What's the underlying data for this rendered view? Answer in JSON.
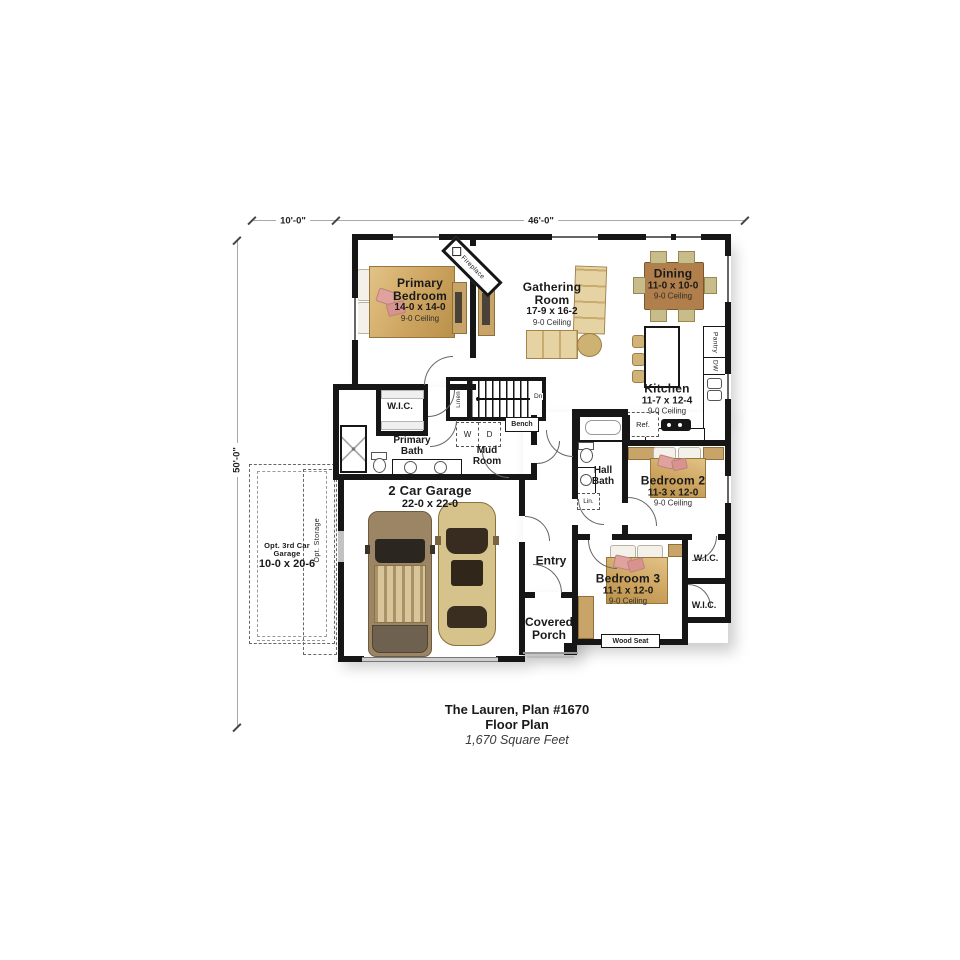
{
  "dims": {
    "top_left": "10'-0\"",
    "top_main": "46'-0\"",
    "left": "50'-0\""
  },
  "rooms": {
    "primary_bedroom": {
      "name": "Primary Bedroom",
      "size": "14-0 x 14-0",
      "ceiling": "9-0 Ceiling"
    },
    "gathering": {
      "name": "Gathering Room",
      "size": "17-9 x 16-2",
      "ceiling": "9-0 Ceiling"
    },
    "dining": {
      "name": "Dining",
      "size": "11-0 x 10-0",
      "ceiling": "9-0 Ceiling"
    },
    "kitchen": {
      "name": "Kitchen",
      "size": "11-7 x 12-4",
      "ceiling": "9-0 Ceiling"
    },
    "bedroom2": {
      "name": "Bedroom 2",
      "size": "11-3 x 12-0",
      "ceiling": "9-0 Ceiling"
    },
    "bedroom3": {
      "name": "Bedroom 3",
      "size": "11-1 x 12-0",
      "ceiling": "9-0 Ceiling"
    },
    "garage": {
      "name": "2 Car Garage",
      "size": "22-0 x 22-0"
    },
    "opt_garage": {
      "name": "Opt. 3rd Car Garage",
      "size": "10-0 x 20-6"
    }
  },
  "labels": {
    "wic": "W.I.C.",
    "primary_bath": "Primary Bath",
    "mud_room": "Mud Room",
    "hall_bath": "Hall Bath",
    "entry": "Entry",
    "covered_porch": "Covered Porch",
    "wood_seat": "Wood Seat",
    "bench": "Bench",
    "linen": "Linen",
    "lin": "Lin.",
    "ref": "Ref.",
    "washer": "W",
    "dryer": "D",
    "dn": "Dn",
    "pantry": "Pantry",
    "dw": "DW",
    "fireplace": "Fireplace",
    "opt_storage": "Opt. Storage"
  },
  "title": {
    "line1": "The Lauren, Plan #1670",
    "line2": "Floor Plan",
    "line3": "1,670 Square Feet"
  },
  "colors": {
    "wall": "#161616",
    "furniture_tan": "#c8a468",
    "pillow_pink": "#e0a29c",
    "table_brown": "#b07f4b",
    "bed_blanket": "#cda45f"
  }
}
